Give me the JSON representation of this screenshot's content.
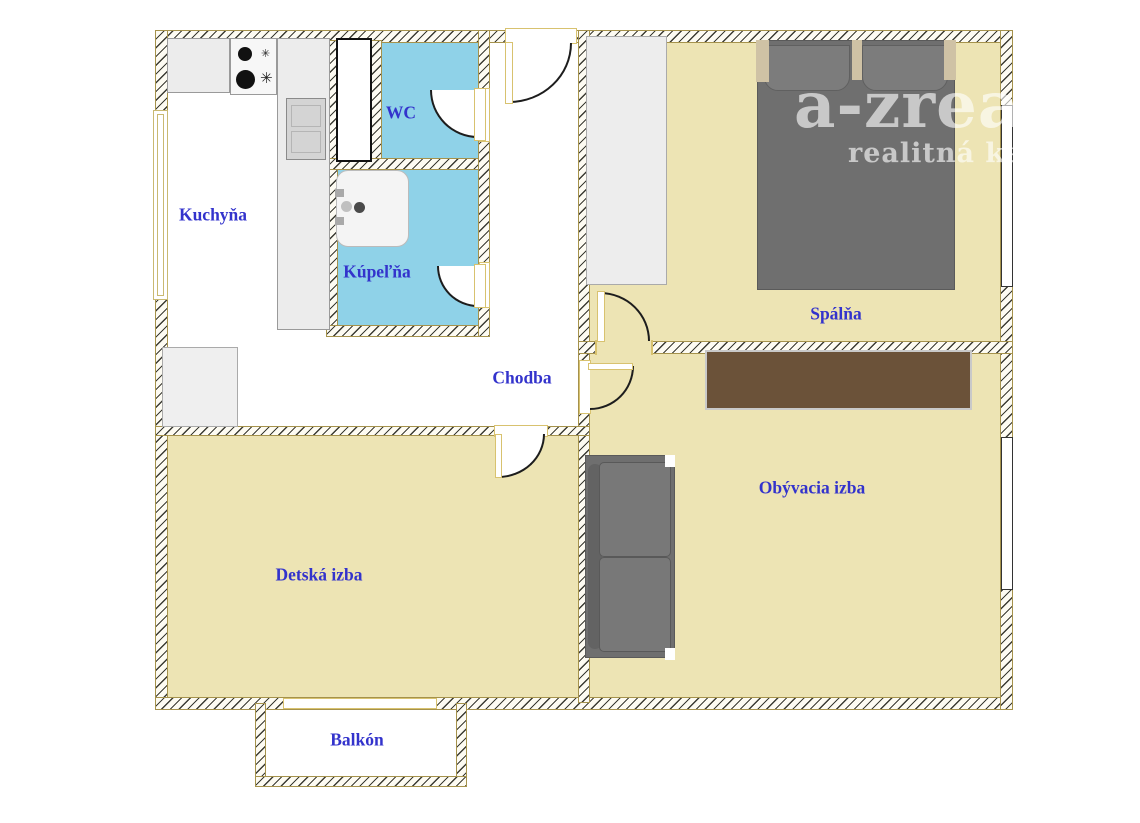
{
  "plan": {
    "type": "apartment-floor-plan",
    "rooms": {
      "kitchen": {
        "label": "Kuchyňa"
      },
      "wc": {
        "label": "WC"
      },
      "bathroom": {
        "label": "Kúpeľňa"
      },
      "hallway": {
        "label": "Chodba"
      },
      "bedroom": {
        "label": "Spálňa"
      },
      "living_room": {
        "label": "Obývacia izba"
      },
      "kids_room": {
        "label": "Detská izba"
      },
      "balcony": {
        "label": "Balkón"
      }
    },
    "watermark": {
      "line1": "a-zrea",
      "line2": "realitná kanc"
    },
    "colors": {
      "floor_beige": "#EDE4B4",
      "floor_blue": "#8FD2E8",
      "label_blue": "#3333CC",
      "wall_trim": "#A5924C",
      "furniture_gray": "#6F6F6F",
      "cabinet_brown": "#6B5239"
    },
    "furniture": [
      "stove",
      "kitchen-counter",
      "sink-unit",
      "tall-cabinet",
      "fridge",
      "bathtub",
      "wardrobe",
      "double-bed",
      "brown-cabinet",
      "sofa"
    ]
  }
}
